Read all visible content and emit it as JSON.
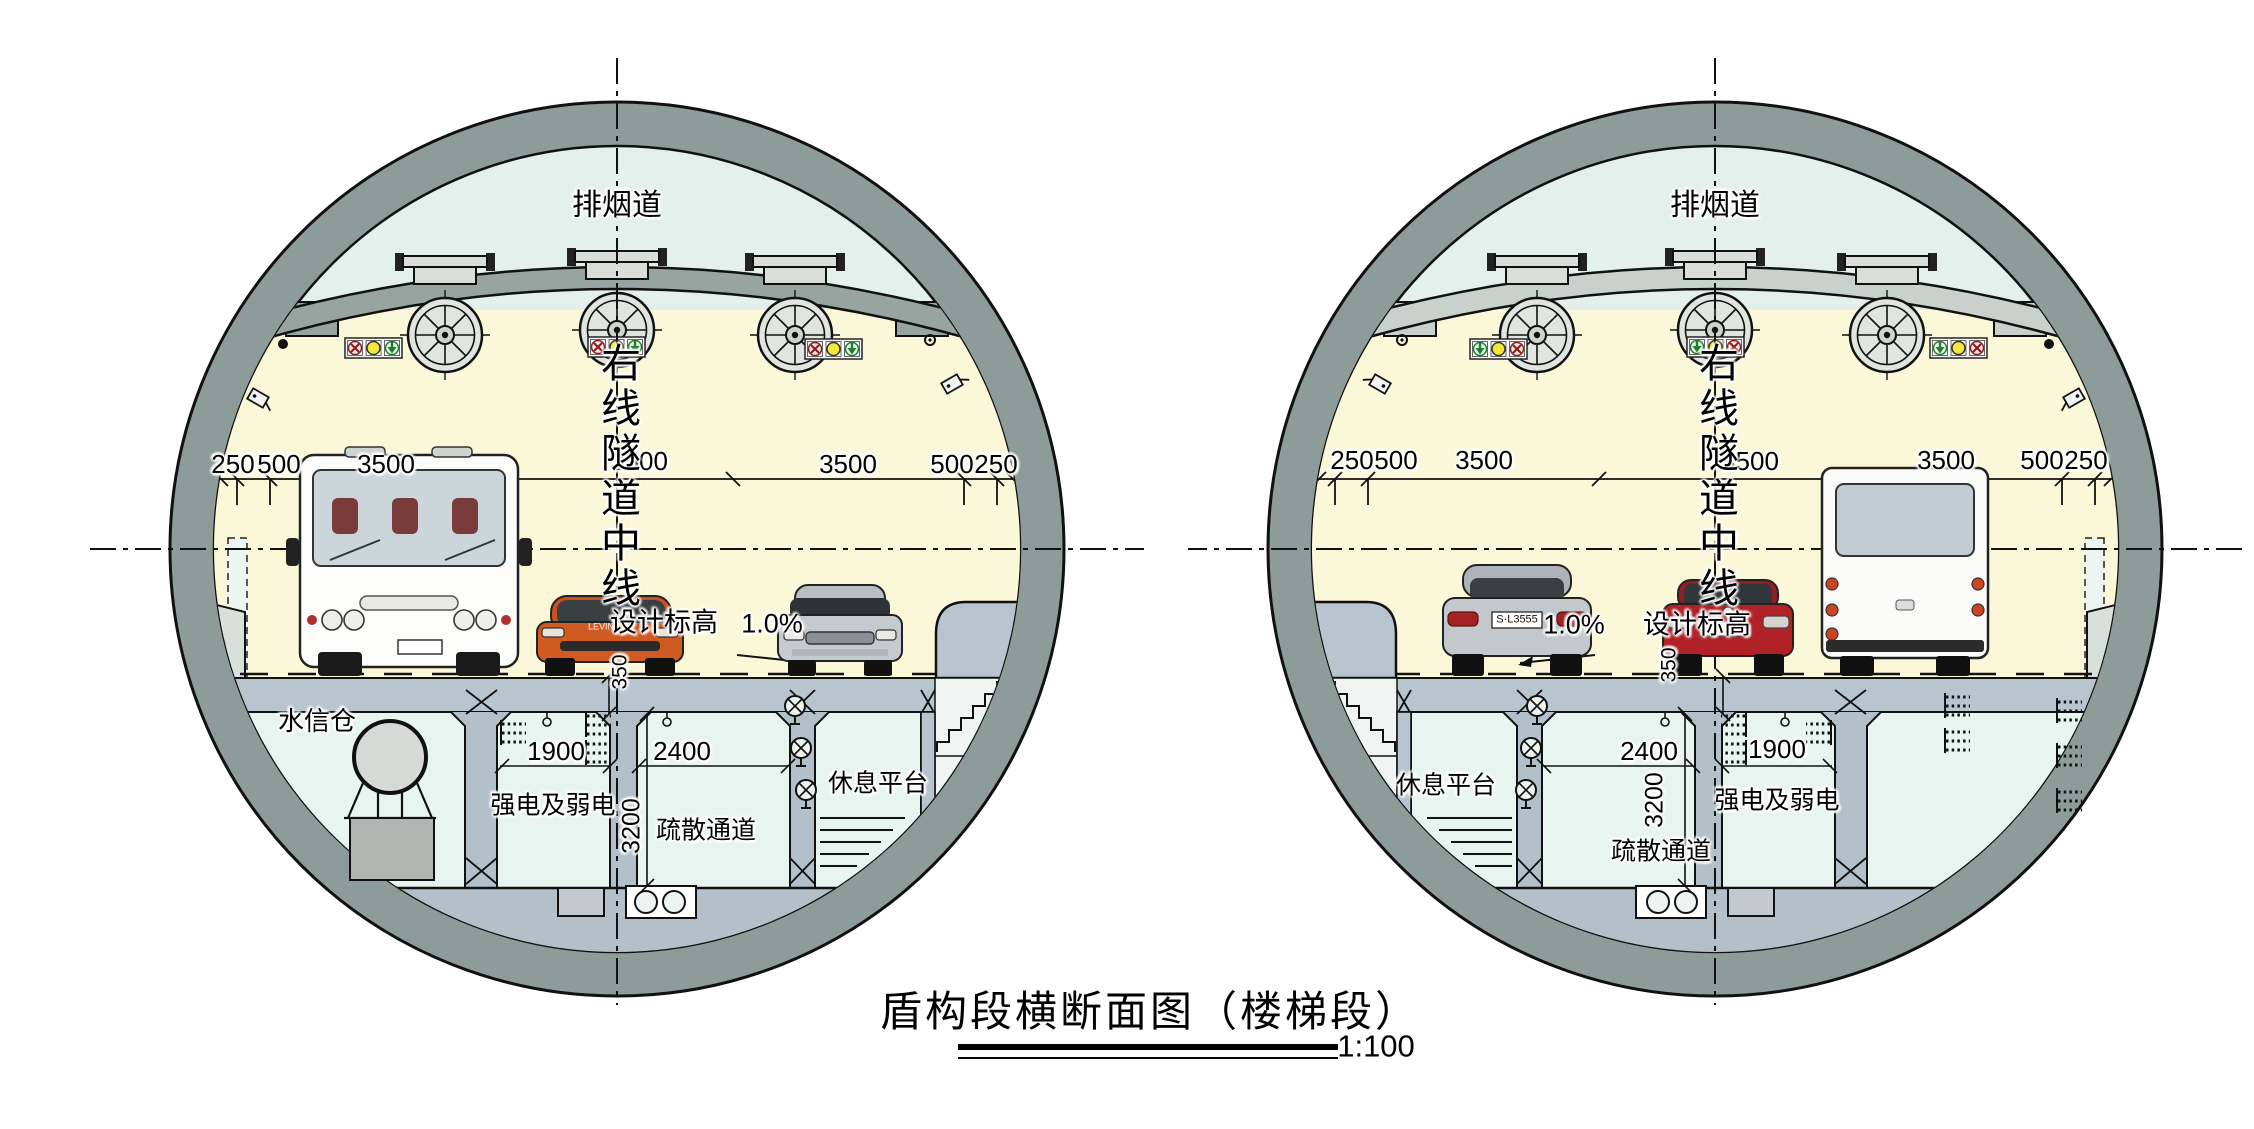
{
  "title": {
    "text": "盾构段横断面图（楼梯段）",
    "scale": "1:100"
  },
  "labels": {
    "duct": "排烟道",
    "tunnel_centerline": "右线隧道中线",
    "design_elevation": "设计标高",
    "slope": "1.0%",
    "slab_thickness": "350",
    "width_1900": "1900",
    "width_2400": "2400",
    "height_3200": "3200",
    "power_room": "强电及弱电",
    "evac_corridor": "疏散通道",
    "water_signal_room": "水信仓",
    "rest_platform": "休息平台"
  },
  "dims_roadway": [
    "250",
    "500",
    "3500",
    "3500",
    "3500",
    "500",
    "250"
  ],
  "vehicles": {
    "levin_badge": "LEVIN",
    "mercedes_plate": "S·L3555"
  },
  "colors": {
    "lining_ring": "#8d9c98",
    "duct_area": "#e4f0ec",
    "roadway_area": "#fbf8d9",
    "room_area": "#e8f4f0",
    "structure": "#b8c5cf",
    "signal_red": "#8f1d1d",
    "signal_yellow": "#f3e73b",
    "signal_green": "#1f7d30",
    "car_orange": "#cf5a22",
    "car_red": "#b02228",
    "car_silver": "#c5cacf"
  }
}
